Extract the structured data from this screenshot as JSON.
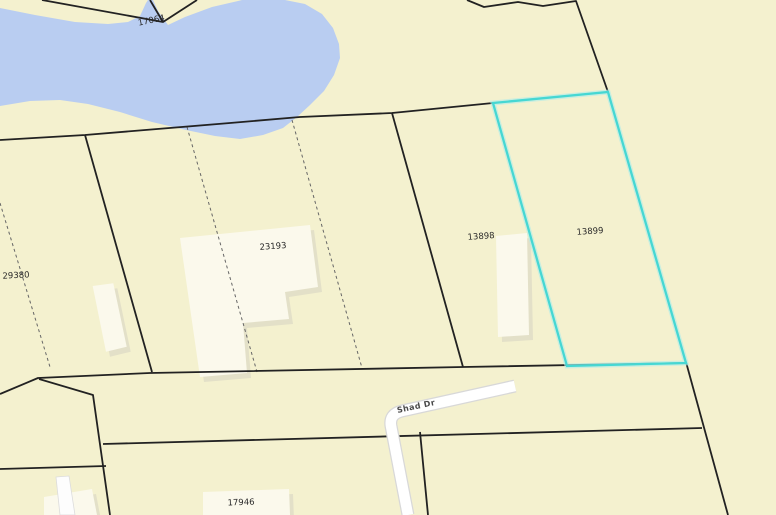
{
  "map": {
    "road": {
      "name": "Shad Dr"
    },
    "parcels": [
      {
        "id": "17064",
        "highlighted": false
      },
      {
        "id": "29380",
        "highlighted": false
      },
      {
        "id": "23193",
        "highlighted": false
      },
      {
        "id": "13898",
        "highlighted": false
      },
      {
        "id": "13899",
        "highlighted": true
      },
      {
        "id": "17946",
        "highlighted": false
      }
    ],
    "colors": {
      "land": "#f4f1cf",
      "water": "#b9cdf1",
      "road_fill": "#ffffff",
      "road_casing": "#d8d8d8",
      "parcel_line": "#222222",
      "lot_line_dashed": "#666666",
      "highlight": "#46d7d3",
      "highlight_halo": "#b2ece8",
      "building": "#fbf9ec",
      "building_shadow": "#e3e0c8",
      "label": "#2a2a2a"
    }
  }
}
